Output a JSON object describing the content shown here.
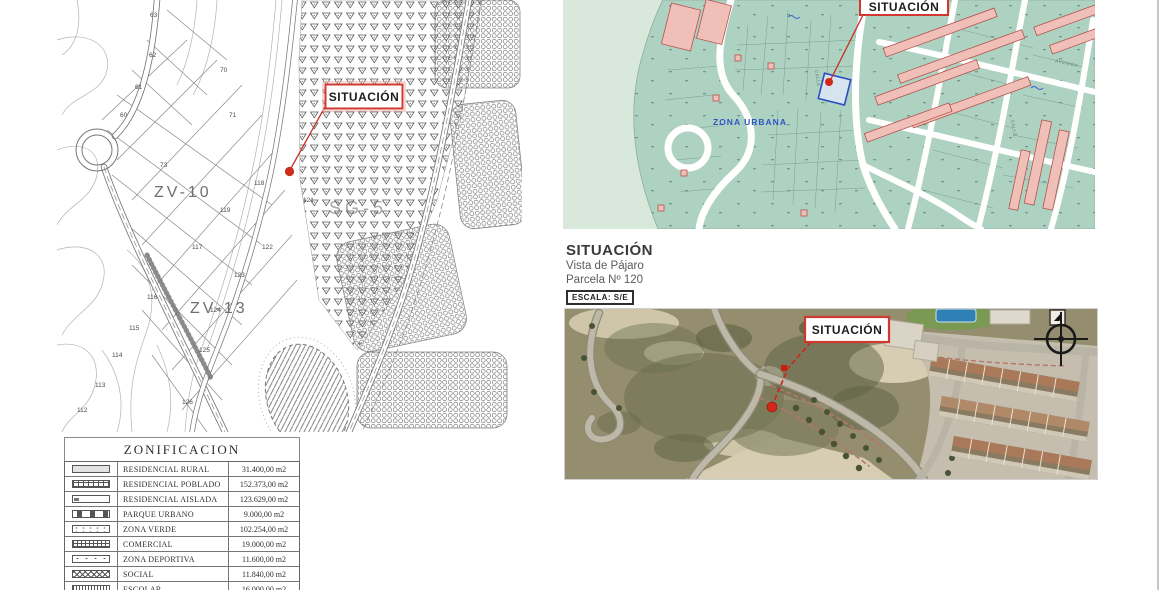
{
  "page": {
    "background": "#ffffff",
    "right_border_color": "#c6c6c6"
  },
  "plan_map": {
    "situacion_label": "SITUACIÓN",
    "zone_labels": {
      "zv10": "ZV-10",
      "zv13": "ZV-13",
      "sg5": "SG-5"
    },
    "parcels": [
      "63",
      "62",
      "61",
      "60",
      "73",
      "70",
      "71",
      "118",
      "119",
      "121",
      "117",
      "122",
      "123",
      "116",
      "124",
      "115",
      "125",
      "114",
      "113",
      "126",
      "112"
    ],
    "marker_color": "#cf2a1c"
  },
  "cadastral_map": {
    "situacion_label": "SITUACIÓN",
    "zona_urbana_label": "ZONA URBANA",
    "street_label": "CALLE",
    "avenue_label": "AVENIDA",
    "background": "#aed2c2",
    "pale_background": "#d8e9dc",
    "building_color": "#f0c0b8",
    "parcel_outline_color": "#1f3fc4",
    "marker_color": "#d1261a"
  },
  "info_block": {
    "title": "SITUACIÓN",
    "subtitle": "Vista de Pájaro",
    "parcel": "Parcela Nº 120",
    "escala": "ESCALA: S/E"
  },
  "aerial_photo": {
    "situacion_label": "SITUACIÓN",
    "marker_color": "#d6261a"
  },
  "legend": {
    "title": "ZONIFICACION",
    "unit": "m2",
    "rows": [
      {
        "name": "RESIDENCIAL RURAL",
        "area": "31.400,00 m2",
        "pattern": "rural"
      },
      {
        "name": "RESIDENCIAL POBLADO",
        "area": "152.373,00 m2",
        "pattern": "poblado"
      },
      {
        "name": "RESIDENCIAL AISLADA",
        "area": "123.629,00 m2",
        "pattern": "aislada"
      },
      {
        "name": "PARQUE URBANO",
        "area": "9.000,00 m2",
        "pattern": "parque"
      },
      {
        "name": "ZONA VERDE",
        "area": "102.254,00 m2",
        "pattern": "verde"
      },
      {
        "name": "COMERCIAL",
        "area": "19.000,00 m2",
        "pattern": "comercial"
      },
      {
        "name": "ZONA DEPORTIVA",
        "area": "11.600,00 m2",
        "pattern": "deportiva"
      },
      {
        "name": "SOCIAL",
        "area": "11.840,00 m2",
        "pattern": "social"
      },
      {
        "name": "ESCOLAR",
        "area": "16.000,00 m2",
        "pattern": "escolar"
      }
    ]
  }
}
